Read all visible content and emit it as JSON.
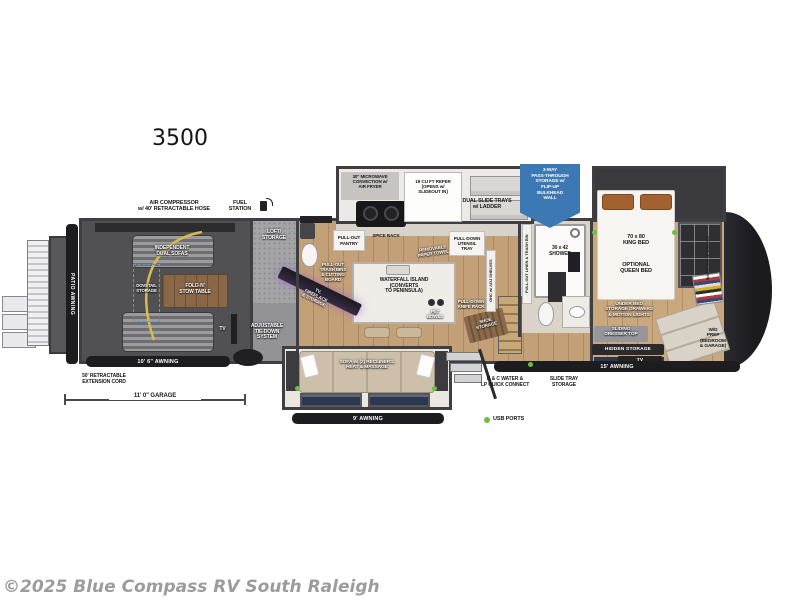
{
  "model": "3500",
  "copyright": "©2025 Blue Compass RV South Raleigh",
  "legend": {
    "usb_ports": "USB PORTS"
  },
  "colors": {
    "badge_blue": "#3c78b4",
    "usb_green": "#6cbf45",
    "awning_black": "#1d1d1f",
    "wall_gray": "#3f3f42",
    "garage_floor": "#515154",
    "wood_floor": "#c3a077",
    "tile_floor": "#d9d3c9",
    "label_dark": "#18181a",
    "dashed_blue": "#5b9bd5",
    "hose_yellow": "#d9ba4d",
    "bed_white": "#f7f5f1",
    "pillow_rust": "#a2622f",
    "sofa_beige": "#cdbfa9",
    "window_navy": "#2c3850",
    "copyright_gray": "#9c9c9c"
  },
  "labels": {
    "patio_awning": "PATIO AWNING",
    "air_compressor": "AIR COMPRESSOR\nw/ 40' RETRACTABLE HOSE",
    "fuel_station": "FUEL\nSTATION",
    "independent_dual_sofas": "INDEPENDENT\nDUAL SOFAS",
    "fold_n_stow_table": "FOLD-N'\nSTOW TABLE",
    "dovetail_storage": "DOVETAIL\nSTORAGE",
    "loft_storage": "LOFT/\nSTORAGE",
    "garage_tv": "TV",
    "adjustable_tie_down": "ADJUSTABLE\nTIE-DOWN\nSYSTEM",
    "garage_awning": "10' 6\" AWNING",
    "extension_cord": "50' RETRACTABLE\nEXTENSION CORD",
    "garage_dimension": "11' 0\" GARAGE",
    "microwave": "30\" MICROWAVE\nCONVECTION w/\nAIR FRYER",
    "refer": "19 CU FT REFER\n[OPENS w/\nSLIDEOUT IN]",
    "pull_out_pantry": "PULL-OUT\nPANTRY",
    "spice_rack": "SPICE RACK",
    "paper_towel": "REMOVABLE\nPAPER TOWEL",
    "utensil_tray": "PULL-DOWN\nUTENSIL\nTRAY",
    "trash_bins": "PULL-OUT\nTRASH BINS\n& CUTTING\nBOARD",
    "waterfall_island": "WATERFALL ISLAND\n(CONVERTS\nTO PENINSULA)",
    "tv_fireplace": "TV,\nFIREPLACE\n& STORAGE",
    "pet_bowls": "PET\nBOWLS",
    "knife_rack": "PULL-DOWN\nKNIFE RACK",
    "shoe_storage": "SHOE\nSTORAGE",
    "ohc_shelves": "OHC w/ ADJ SHELVES",
    "sofa_recliners": "SOFA w/ (2) RECLINERS,\nHEAT & MASSAGE",
    "nine_awning": "9' AWNING",
    "dual_slide_trays": "DUAL SLIDE TRAYS\nw/ LADDER",
    "pass_through": "3-WAY\nPASS-THROUGH\nSTORAGE w/\nFLIP-UP\nBULKHEAD\nWALL",
    "linen_trash": "PULL-OUT LINEN & TRASH BIN",
    "shower": "30 x 42\nSHOWER",
    "king_bed": "70 x 80\nKING BED",
    "optional_queen": "OPTIONAL\nQUEEN BED",
    "under_bed": "UNDER BED\nSTORAGE DRAWERS\n& MOTION LIGHTS",
    "sliding_dresser": "SLIDING\nDRESSER TOP",
    "hidden_storage": "HIDDEN STORAGE",
    "bedroom_tv": "TV",
    "wd_prep": "W/D\nPREP\n(BEDROOM\n& GARAGE)",
    "wardrobe": "WARDROBE w/ SHELVES",
    "fifteen_awning": "15' AWNING",
    "hc_water": "H & C WATER &\nLP QUICK CONNECT",
    "slide_tray_storage": "SLIDE TRAY\nSTORAGE"
  }
}
